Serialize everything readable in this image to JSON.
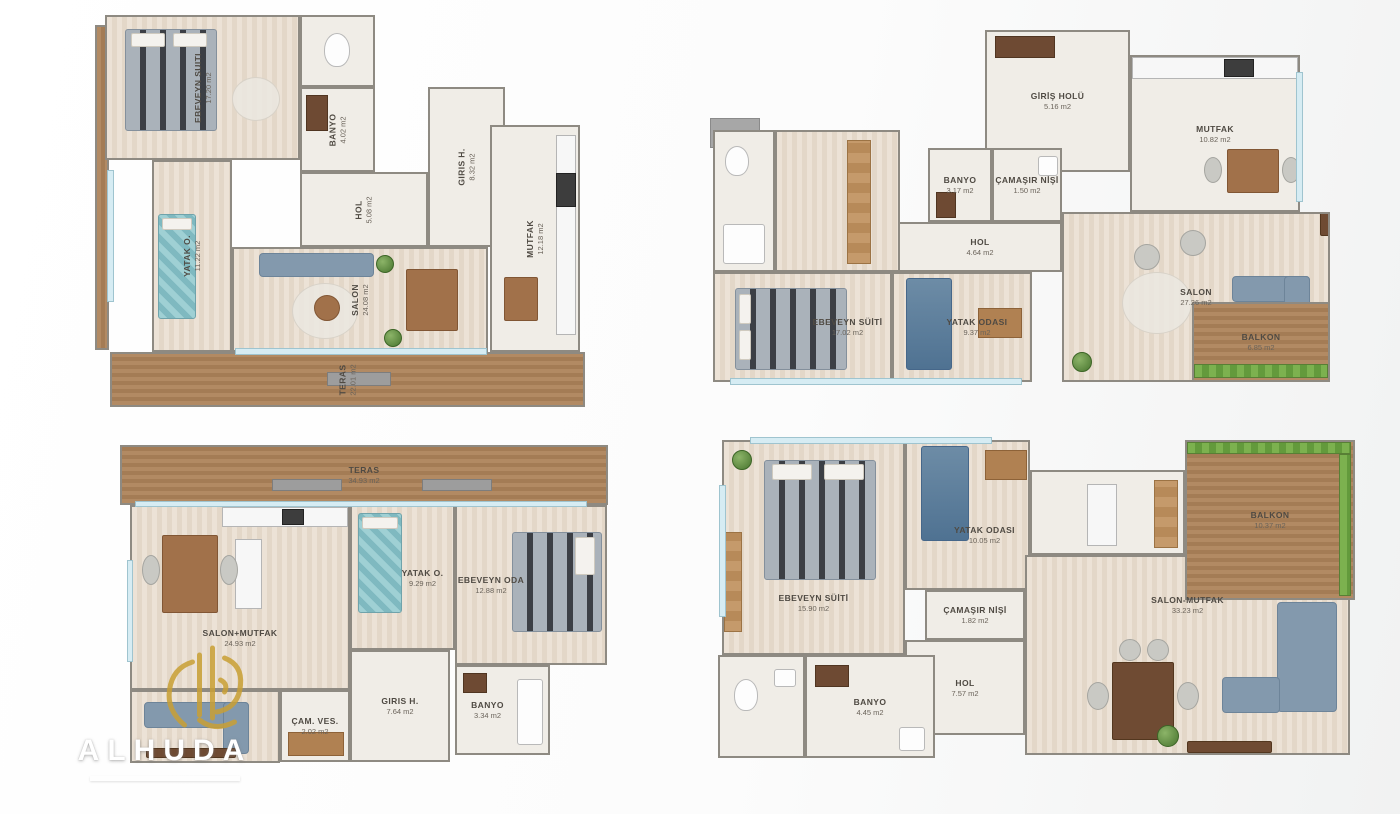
{
  "watermark": {
    "brand": "ALHUDA"
  },
  "plans": [
    {
      "name": "top-left",
      "rooms": [
        {
          "label": "EBEVEYN SUITI",
          "area": "17.20 m2"
        },
        {
          "label": "BANYO",
          "area": "4.02 m2"
        },
        {
          "label": "GIRIS H.",
          "area": "8.32 m2"
        },
        {
          "label": "HOL",
          "area": "5.08 m2"
        },
        {
          "label": "YATAK O.",
          "area": "11.22 m2"
        },
        {
          "label": "SALON",
          "area": "24.08 m2"
        },
        {
          "label": "MUTFAK",
          "area": "12.18 m2"
        },
        {
          "label": "TERAS",
          "area": "22.01 m2"
        }
      ]
    },
    {
      "name": "top-right",
      "rooms": [
        {
          "label": "GİRİŞ HOLÜ",
          "area": "5.16 m2"
        },
        {
          "label": "MUTFAK",
          "area": "10.82 m2"
        },
        {
          "label": "BANYO",
          "area": "3.17 m2"
        },
        {
          "label": "ÇAMAŞIR NİŞİ",
          "area": "1.50 m2"
        },
        {
          "label": "HOL",
          "area": "4.64 m2"
        },
        {
          "label": "SALON",
          "area": "27.26 m2"
        },
        {
          "label": "EBEVEYN SÜİTİ",
          "area": "17.02 m2"
        },
        {
          "label": "YATAK ODASI",
          "area": "9.37 m2"
        },
        {
          "label": "BALKON",
          "area": "6.85 m2"
        }
      ]
    },
    {
      "name": "bottom-left",
      "rooms": [
        {
          "label": "TERAS",
          "area": "34.93 m2"
        },
        {
          "label": "SALON+MUTFAK",
          "area": "24.93 m2"
        },
        {
          "label": "YATAK O.",
          "area": "9.29 m2"
        },
        {
          "label": "EBEVEYN ODA",
          "area": "12.88 m2"
        },
        {
          "label": "GIRIS H.",
          "area": "7.64 m2"
        },
        {
          "label": "ÇAM. VES.",
          "area": "2.02 m2"
        },
        {
          "label": "BANYO",
          "area": "3.34 m2"
        }
      ]
    },
    {
      "name": "bottom-right",
      "rooms": [
        {
          "label": "EBEVEYN SÜİTİ",
          "area": "15.90 m2"
        },
        {
          "label": "YATAK ODASI",
          "area": "10.05 m2"
        },
        {
          "label": "BALKON",
          "area": "10.37 m2"
        },
        {
          "label": "ÇAMAŞIR NİŞİ",
          "area": "1.82 m2"
        },
        {
          "label": "HOL",
          "area": "7.57 m2"
        },
        {
          "label": "SALON-MUTFAK",
          "area": "33.23 m2"
        },
        {
          "label": "BANYO",
          "area": "4.45 m2"
        }
      ]
    }
  ],
  "colors": {
    "deck": "#ab835c",
    "grass": "#79ad4c",
    "wall": "#8e8a82",
    "window": "#d6ecf3",
    "gold": "#c9a035"
  }
}
